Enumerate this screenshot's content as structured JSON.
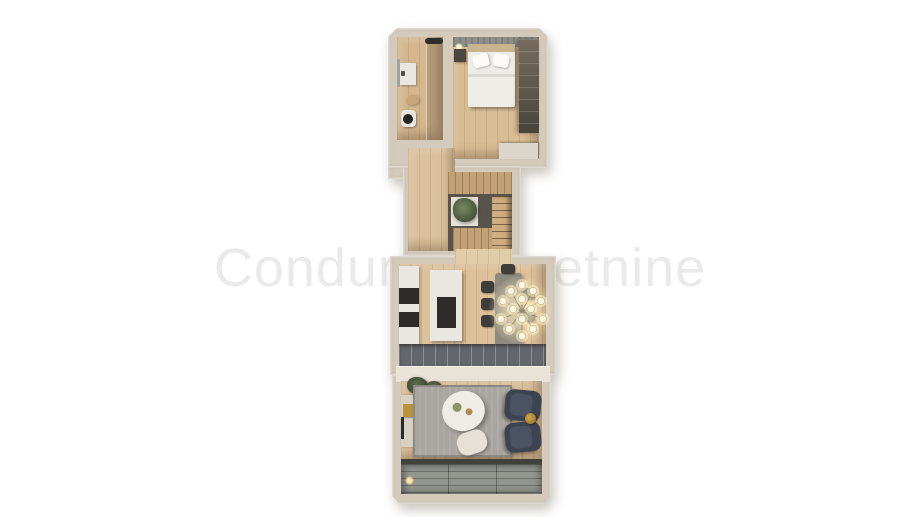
{
  "watermark": {
    "text": "Condura nekretnine"
  },
  "colors": {
    "background": "#ffffff",
    "watermark": "#eaeaea",
    "wall": "#d5cbbd",
    "wall_light": "#e9e3d8",
    "wall_edge": "#c2b7a7",
    "floor_wood": "#d8bc94",
    "floor_wood_light": "#e3cda9",
    "floor_hall": "#dcc29c",
    "panel_wood": "#c2a176",
    "stair_tread": "#cfae81",
    "stair_void": "#59544b",
    "headboard": "#8f8d88",
    "bed_white": "#efede7",
    "furniture_white": "#eae7e0",
    "appliance_dark": "#2e2c29",
    "dining_table": "#8f8a80",
    "chair_dark": "#3f3d39",
    "glow": "#f7e7bd",
    "glass_band": "#63666a",
    "rug": "#a9a59f",
    "armchair": "#3d4451",
    "gold": "#bb913a",
    "deck": "#93958f",
    "plant": "#55644a",
    "tv_dark": "#2a2a2a",
    "threshold": "#42413c"
  }
}
